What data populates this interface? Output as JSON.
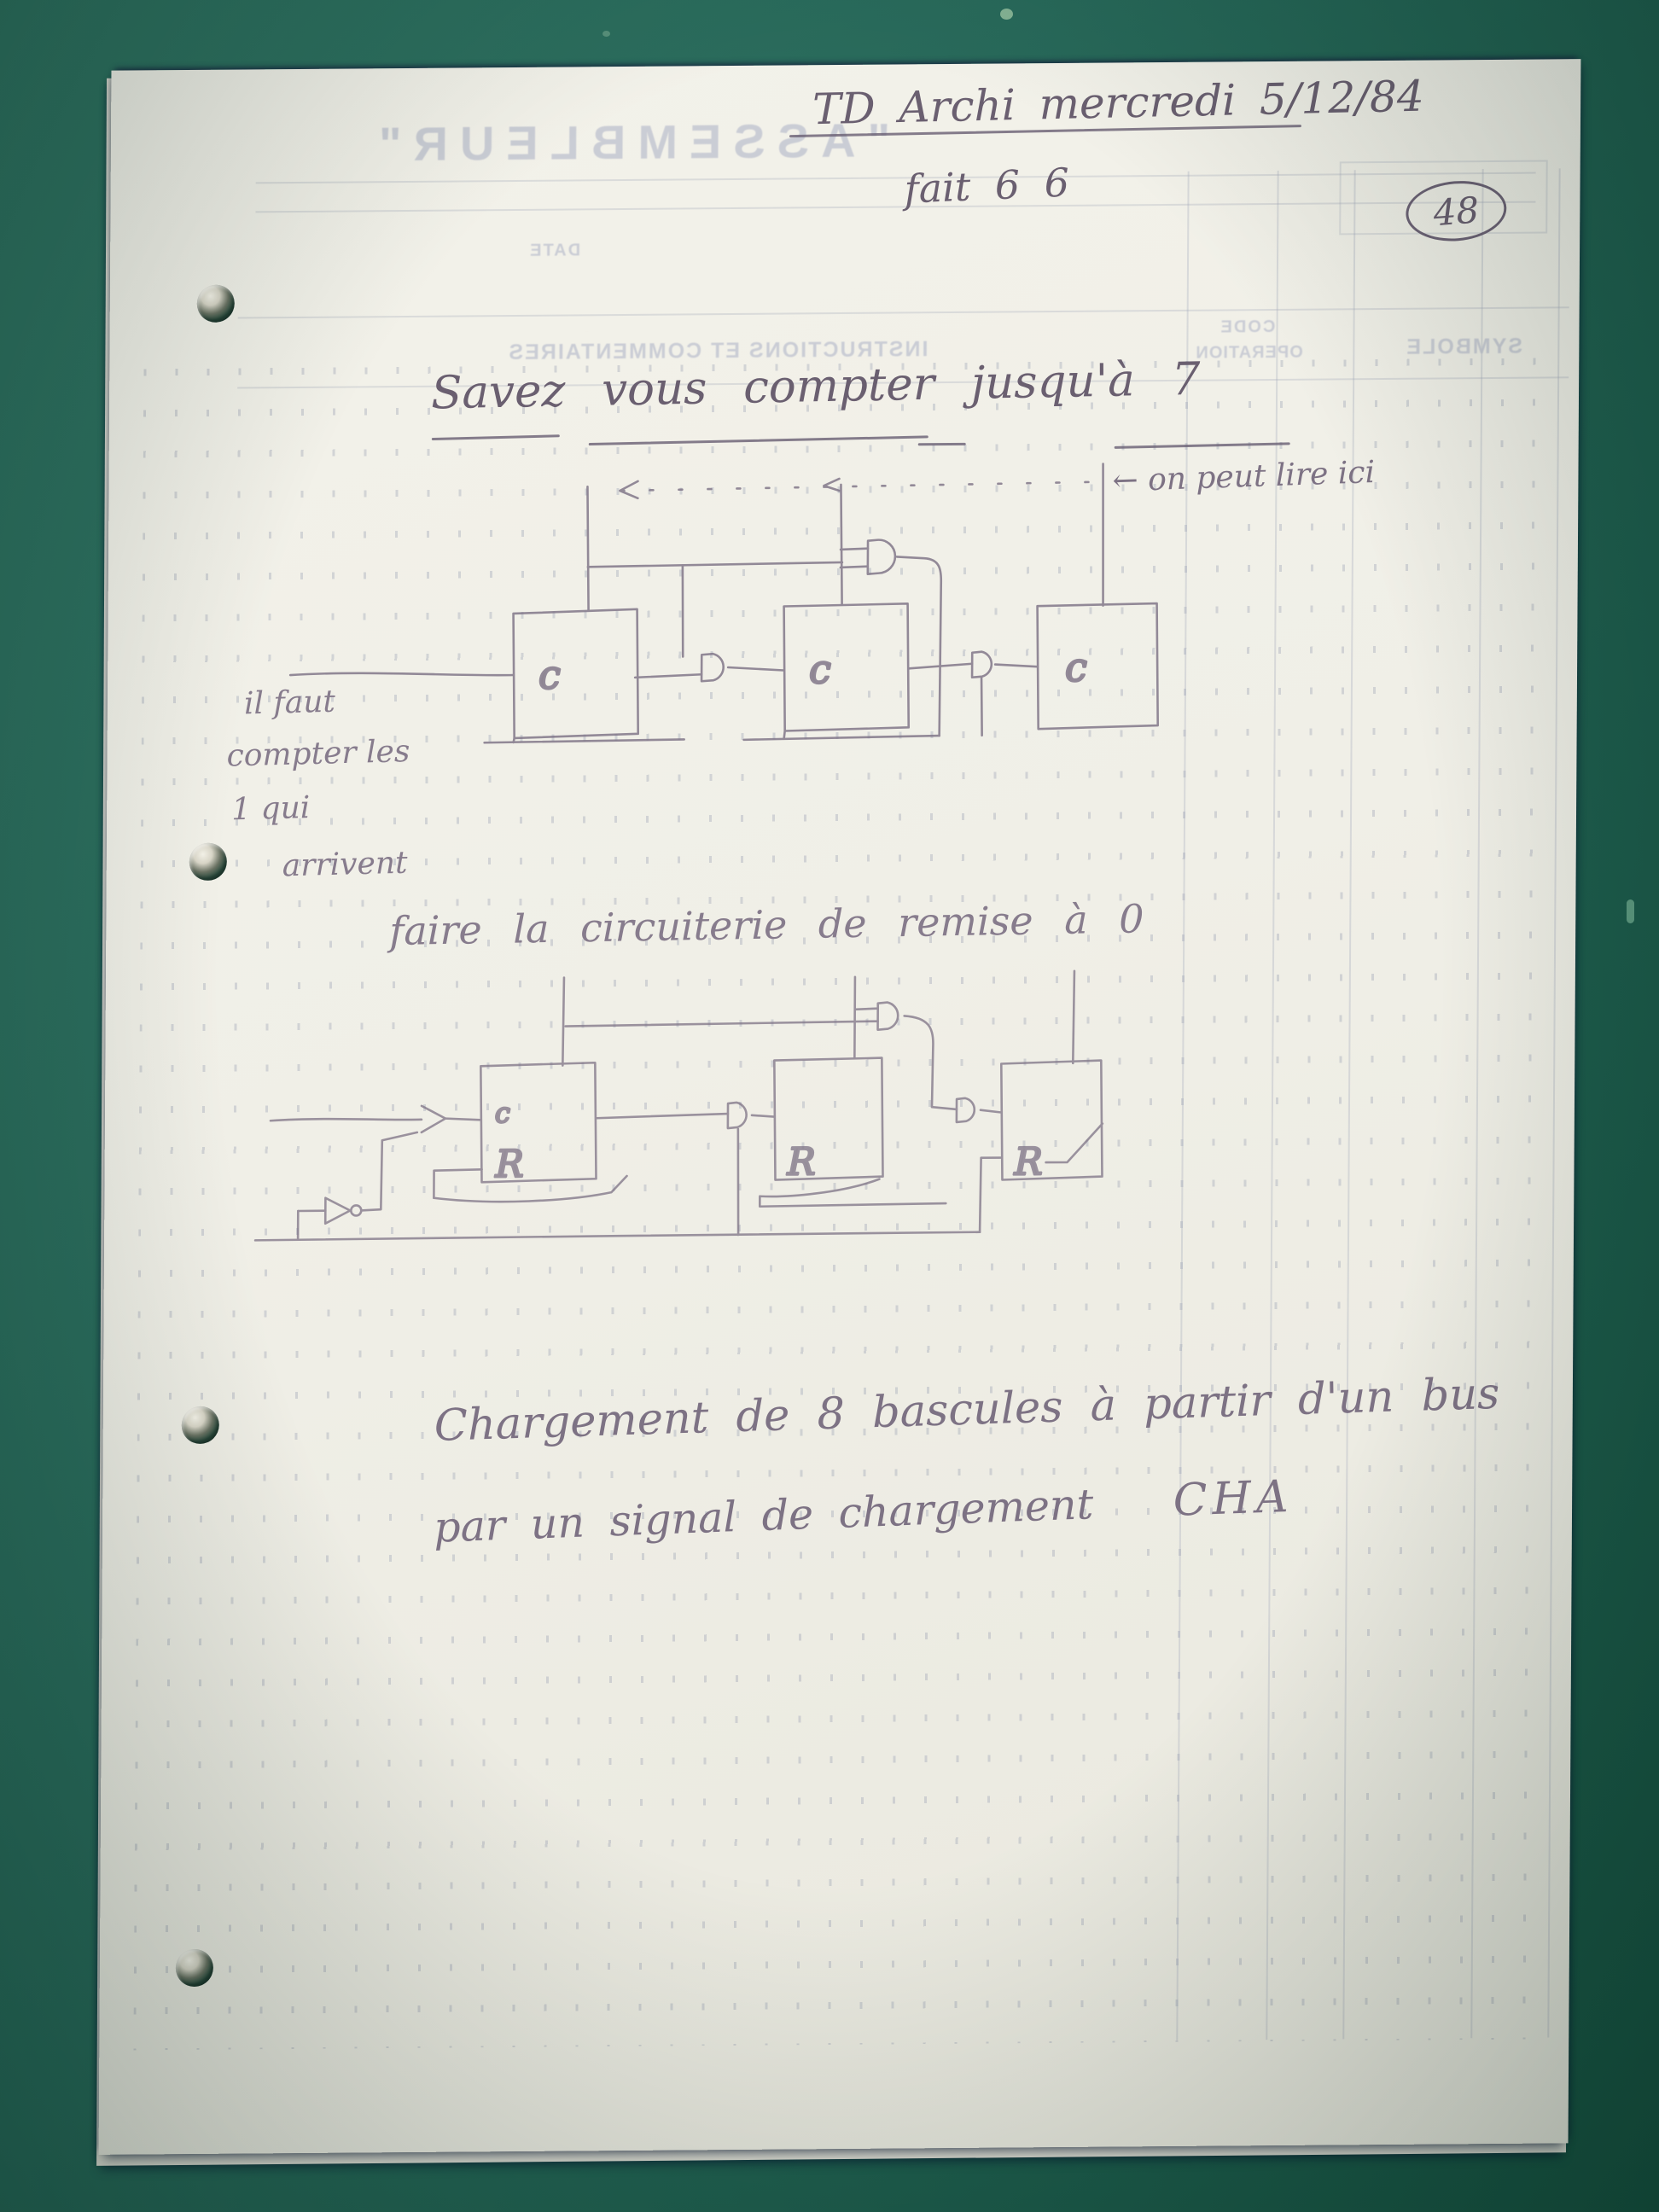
{
  "header": {
    "course_line": "TD Archi mercredi 5/12/84",
    "status_line": "fait 6 6",
    "page_number": "48"
  },
  "title": {
    "text": "Savez vous compter jusqu'à 7"
  },
  "annotations": {
    "read_here": "← on peut lire ici",
    "count_note": [
      "il faut",
      "compter les",
      "1 qui",
      "arrivent"
    ]
  },
  "captions": {
    "reset": "faire la circuiterie de remise à 0"
  },
  "paragraph": {
    "line1": "Chargement de 8 bascules à partir d'un bus",
    "line2": "par un signal de chargement",
    "signal_name": "CHA"
  },
  "diagram1": {
    "clock_label": "c"
  },
  "diagram2": {
    "clock_label": "c",
    "reset_label": "R"
  },
  "bleedthrough": {
    "form_title": "\"ASSEMBLEUR\"",
    "field_date": "DATE",
    "col_comments": "INSTRUCTIONS ET COMMENTAIRES",
    "col_code_line1": "CODE",
    "col_code_line2": "OPERATION",
    "col_symbol": "SYMBOLE"
  }
}
